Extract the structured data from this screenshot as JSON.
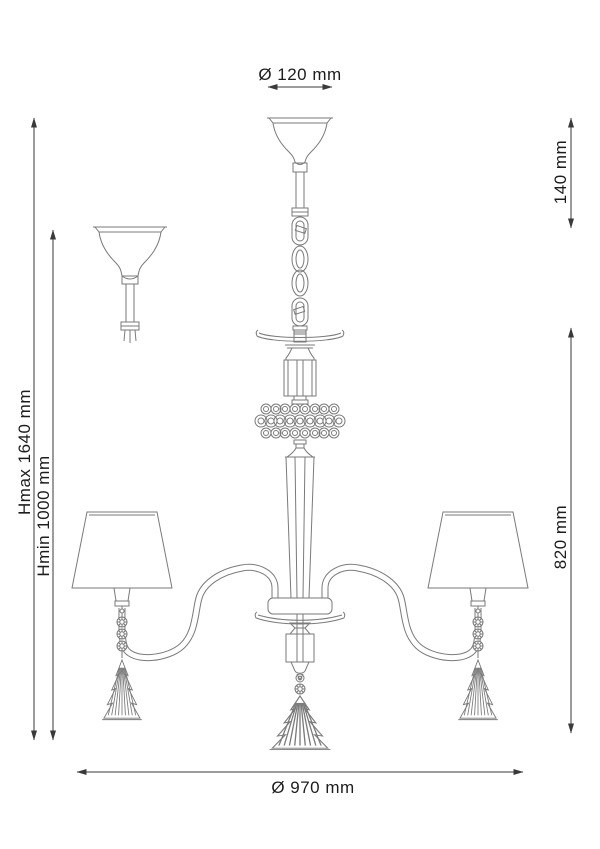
{
  "page": {
    "background": "#ffffff",
    "description": "Technical dimension drawing of a 3-arm chandelier with shades, crystal bead ring and fir-tree crystal pendants"
  },
  "drawing": {
    "fixture_line_color": "#7a7a7a",
    "dimension_line_color": "#3a3a3a",
    "text_color": "#1c1c1c"
  },
  "dimensions": {
    "canopy_diameter": "Ø 120 mm",
    "canopy_height": "140 mm",
    "height_max": "Hmax 1640 mm",
    "height_min": "Hmin 1000 mm",
    "body_height": "820 mm",
    "overall_diameter": "Ø 970 mm"
  }
}
